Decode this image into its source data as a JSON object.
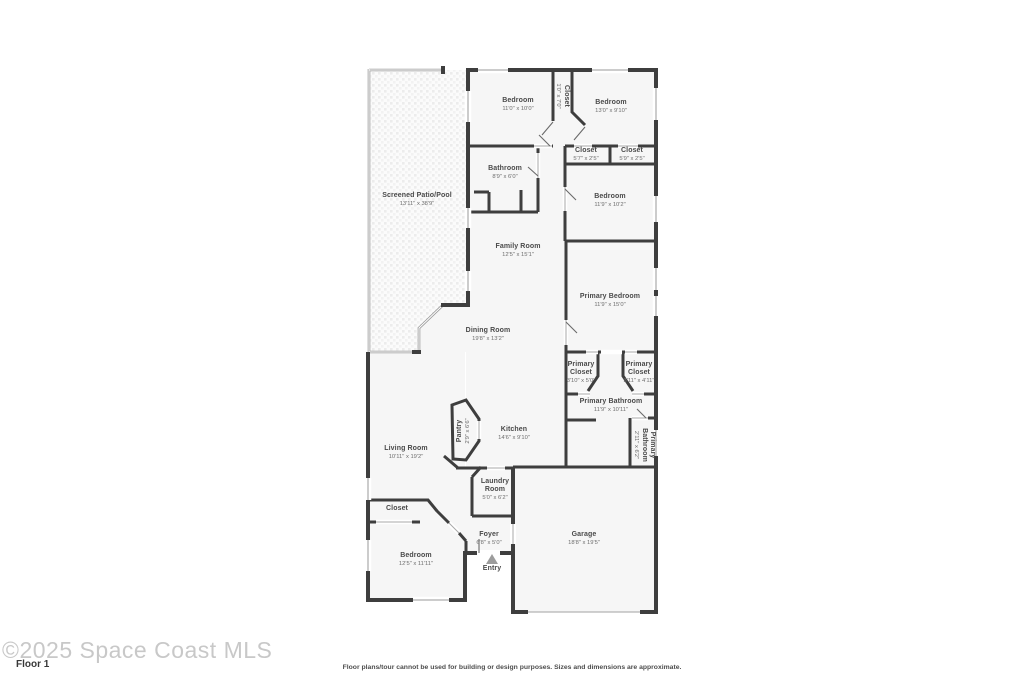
{
  "watermark": {
    "text": "©2025 Space Coast MLS",
    "floor_label": "Floor 1"
  },
  "footer": {
    "disclaimer": "Floor plans/tour cannot be used for building or design purposes. Sizes and dimensions are approximate."
  },
  "colors": {
    "wall": "#3e3e3e",
    "floor": "#f6f6f6",
    "patio_line": "#9a9a9a",
    "room_label": "#4a4a4a",
    "room_dims": "#6e6e6e",
    "watermark": "#c8c8c8",
    "entry_marker": "#9c9c9c"
  },
  "icons": {
    "entry_marker": "triangle-up-icon"
  },
  "rooms": {
    "screened_patio": {
      "name": "Screened Patio/Pool",
      "dims": "13'11\" x 38'9\""
    },
    "bedroom_top_left": {
      "name": "Bedroom",
      "dims": "11'0\" x 10'0\""
    },
    "hall_closet": {
      "name": "Closet",
      "dims": "1'0\" x 7'0\""
    },
    "bedroom_top_right": {
      "name": "Bedroom",
      "dims": "13'0\" x 9'10\""
    },
    "closet_left": {
      "name": "Closet",
      "dims": "5'7\" x 2'5\""
    },
    "closet_right": {
      "name": "Closet",
      "dims": "5'9\" x 2'5\""
    },
    "bathroom": {
      "name": "Bathroom",
      "dims": "8'9\" x 6'0\""
    },
    "bedroom_right": {
      "name": "Bedroom",
      "dims": "11'9\" x 10'2\""
    },
    "family_room": {
      "name": "Family Room",
      "dims": "12'5\" x 15'1\""
    },
    "primary_bedroom": {
      "name": "Primary Bedroom",
      "dims": "11'9\" x 15'0\""
    },
    "dining_room": {
      "name": "Dining Room",
      "dims": "19'8\" x 13'2\""
    },
    "primary_closet_left": {
      "name": "Primary Closet",
      "dims": "3'10\" x 5'0\""
    },
    "primary_closet_right": {
      "name": "Primary Closet",
      "dims": "3'11\" x 4'11\""
    },
    "primary_bathroom": {
      "name": "Primary Bathroom",
      "dims": "11'9\" x 10'11\""
    },
    "pantry": {
      "name": "Pantry",
      "dims": "2'9\" x 6'6\""
    },
    "kitchen": {
      "name": "Kitchen",
      "dims": "14'6\" x 9'10\""
    },
    "living_room": {
      "name": "Living Room",
      "dims": "10'11\" x 19'2\""
    },
    "primary_bathroom_small": {
      "name": "Primary Bathroom",
      "dims": "2'11\" x 6'2\""
    },
    "laundry_room": {
      "name": "Laundry Room",
      "dims": "5'0\" x 6'2\""
    },
    "closet_bottom": {
      "name": "Closet"
    },
    "bedroom_bottom": {
      "name": "Bedroom",
      "dims": "12'5\" x 11'11\""
    },
    "foyer": {
      "name": "Foyer",
      "dims": "6'8\" x 5'0\""
    },
    "entry": {
      "name": "Entry"
    },
    "garage": {
      "name": "Garage",
      "dims": "18'8\" x 19'5\""
    }
  }
}
